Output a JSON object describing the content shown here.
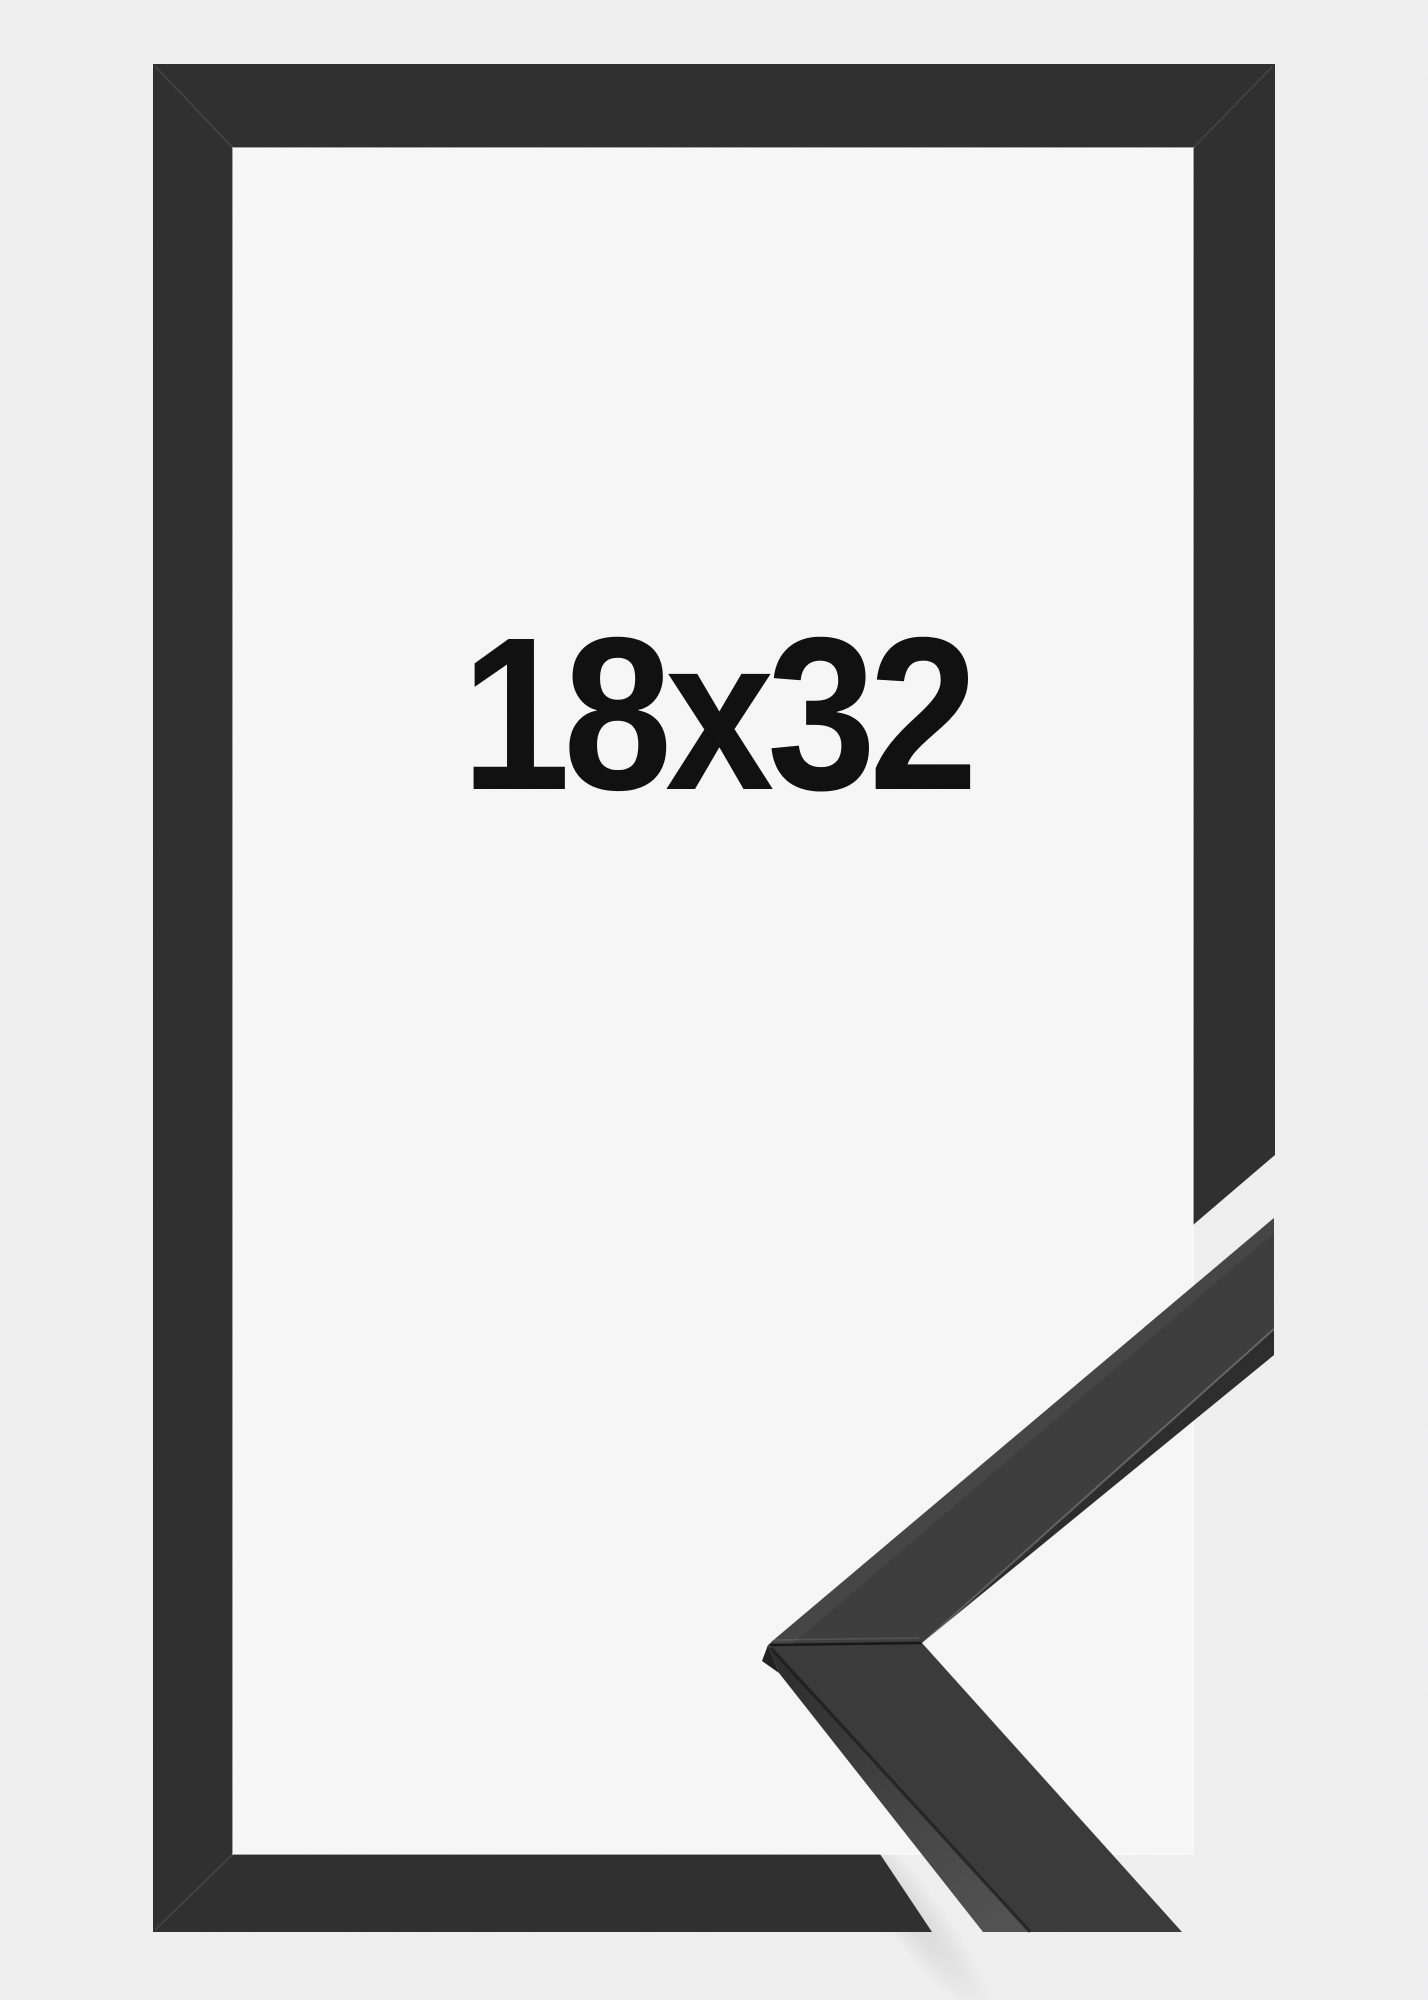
{
  "frame_product_image": {
    "size_label": "18x32",
    "colors": {
      "background": "#f0f0f1",
      "mat": "#f7f7f8",
      "frame": "#2d2d2e",
      "label": "#0d0d0d",
      "sample_upper_front": "#3b3b3b",
      "sample_lower_front": "#383838",
      "sample_edge_strip": "#2a2a2a"
    }
  }
}
